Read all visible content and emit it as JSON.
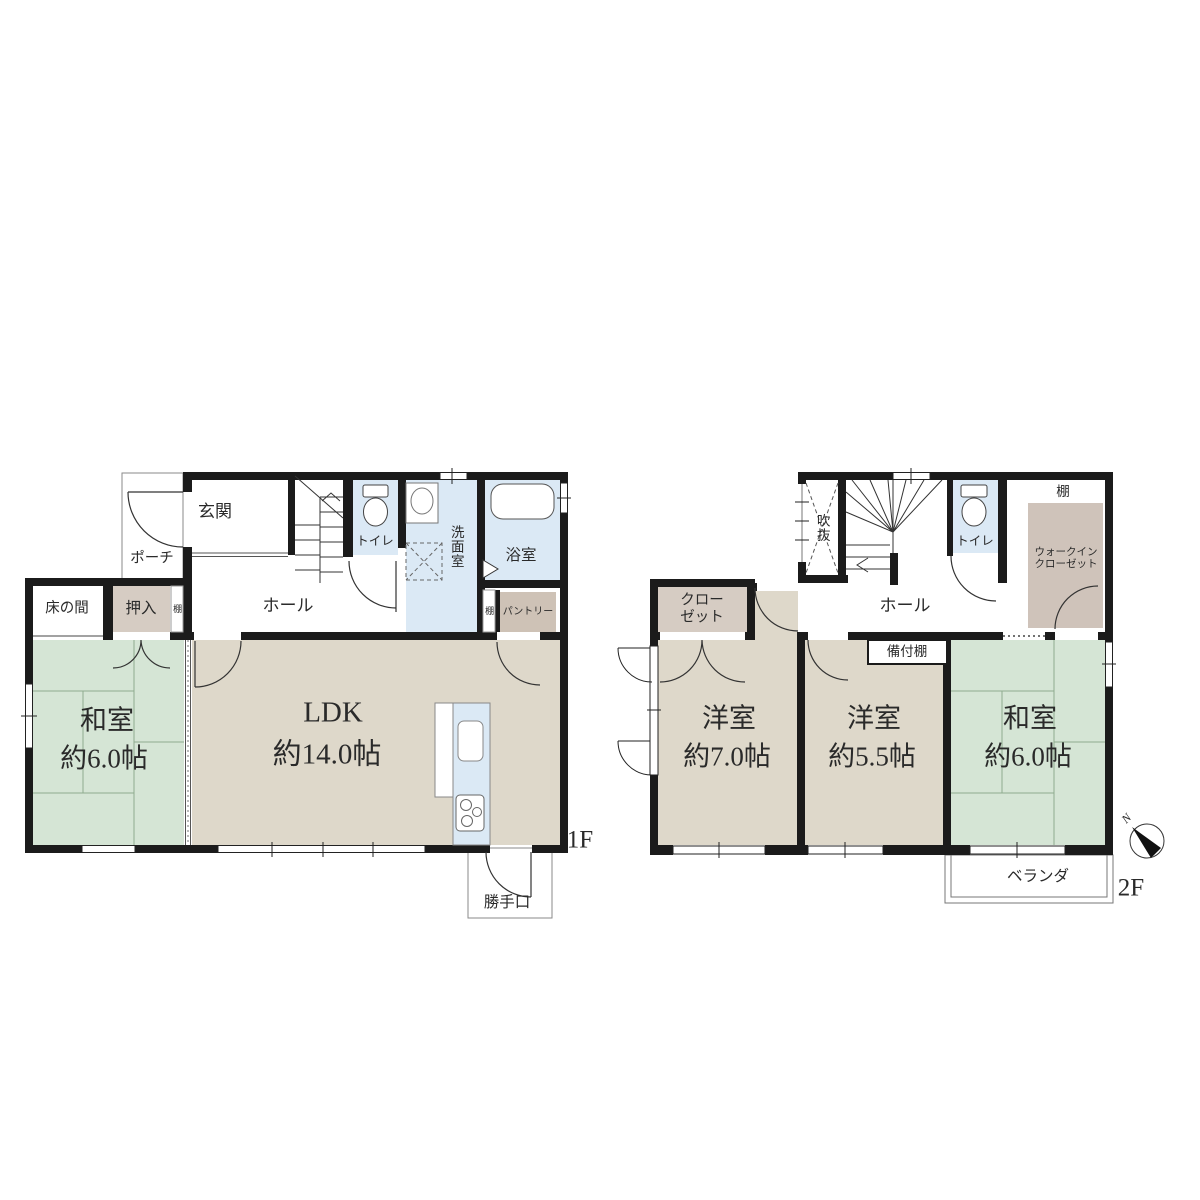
{
  "colors": {
    "wall": "#1b1b1b",
    "tatami_green": "#d5e5d5",
    "room_beige": "#ded8ca",
    "closet_brown": "#d6ccc3",
    "water_blue": "#dbe9f5",
    "pantry_brown": "#cec2b6",
    "wic_shelf_brown": "#cfc3ba",
    "line_gray": "#333333"
  },
  "f1": {
    "floor_label": "1F",
    "porch": "ポーチ",
    "entrance": "玄関",
    "hall": "ホール",
    "tokonoma": "床の間",
    "oshiire": "押入",
    "shelf_hall": "棚",
    "toilet": "トイレ",
    "washroom": "洗面室",
    "bathroom": "浴室",
    "shelf_pantry": "棚",
    "pantry": "パントリー",
    "washitsu_name": "和室",
    "washitsu_size": "約6.0帖",
    "ldk_name": "LDK",
    "ldk_size": "約14.0帖",
    "back_door": "勝手口"
  },
  "f2": {
    "floor_label": "2F",
    "void": "吹抜",
    "toilet": "トイレ",
    "shelf": "棚",
    "wic_line1": "ウォークイン",
    "wic_line2": "クローゼット",
    "closet_line1": "クロー",
    "closet_line2": "ゼット",
    "hall": "ホール",
    "built_in_shelf": "備付棚",
    "western1_name": "洋室",
    "western1_size": "約7.0帖",
    "western2_name": "洋室",
    "western2_size": "約5.5帖",
    "washitsu_name": "和室",
    "washitsu_size": "約6.0帖",
    "veranda": "ベランダ",
    "compass_n": "N"
  }
}
